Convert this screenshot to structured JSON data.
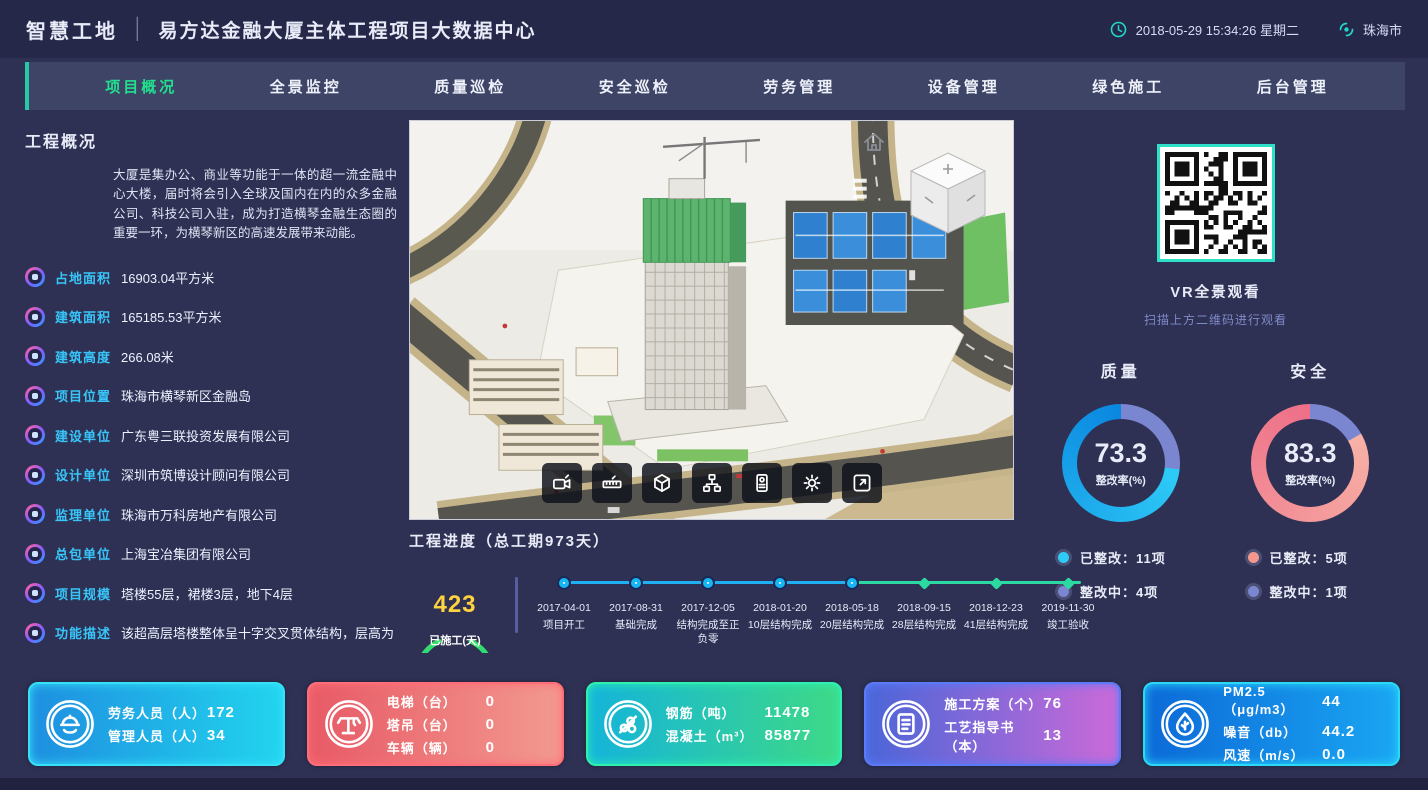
{
  "header": {
    "brand": "智慧工地",
    "title": "易方达金融大厦主体工程项目大数据中心",
    "datetime": "2018-05-29 15:34:26 星期二",
    "city": "珠海市"
  },
  "nav": {
    "items": [
      {
        "label": "项目概况",
        "active": true
      },
      {
        "label": "全景监控",
        "active": false
      },
      {
        "label": "质量巡检",
        "active": false
      },
      {
        "label": "安全巡检",
        "active": false
      },
      {
        "label": "劳务管理",
        "active": false
      },
      {
        "label": "设备管理",
        "active": false
      },
      {
        "label": "绿色施工",
        "active": false
      },
      {
        "label": "后台管理",
        "active": false
      }
    ]
  },
  "overview": {
    "title": "工程概况",
    "description": "大厦是集办公、商业等功能于一体的超一流金融中心大楼，届时将会引入全球及国内在内的众多金融公司、科技公司入驻，成为打造横琴金融生态圈的重要一环，为横琴新区的高速发展带来动能。",
    "fields": [
      {
        "label": "占地面积",
        "value": "16903.04平方米"
      },
      {
        "label": "建筑面积",
        "value": "165185.53平方米"
      },
      {
        "label": "建筑高度",
        "value": "266.08米"
      },
      {
        "label": "项目位置",
        "value": "珠海市横琴新区金融岛"
      },
      {
        "label": "建设单位",
        "value": "广东粤三联投资发展有限公司"
      },
      {
        "label": "设计单位",
        "value": "深圳市筑博设计顾问有限公司"
      },
      {
        "label": "监理单位",
        "value": "珠海市万科房地产有限公司"
      },
      {
        "label": "总包单位",
        "value": "上海宝冶集团有限公司"
      },
      {
        "label": "项目规模",
        "value": "塔楼55层，裙楼3层，地下4层"
      },
      {
        "label": "功能描述",
        "value": "该超高层塔楼整体呈十字交叉贯体结构，层高为"
      }
    ]
  },
  "viewer": {
    "toolbar_icons": [
      "video-icon",
      "measure-icon",
      "cube-icon",
      "structure-icon",
      "badge-icon",
      "settings-icon",
      "fullscreen-icon"
    ]
  },
  "progress": {
    "title": "工程进度（总工期973天）",
    "gauge": {
      "value": "423",
      "label": "已施工(天)"
    },
    "milestones": [
      {
        "date": "2017-04-01",
        "label": "项目开工",
        "done": true
      },
      {
        "date": "2017-08-31",
        "label": "基础完成",
        "done": true
      },
      {
        "date": "2017-12-05",
        "label": "结构完成至正负零",
        "done": true
      },
      {
        "date": "2018-01-20",
        "label": "10层结构完成",
        "done": true
      },
      {
        "date": "2018-05-18",
        "label": "20层结构完成",
        "done": true
      },
      {
        "date": "2018-09-15",
        "label": "28层结构完成",
        "done": false
      },
      {
        "date": "2018-12-23",
        "label": "41层结构完成",
        "done": false
      },
      {
        "date": "2019-11-30",
        "label": "竣工验收",
        "done": false
      }
    ]
  },
  "vr": {
    "title": "VR全景观看",
    "subtitle": "扫描上方二维码进行观看"
  },
  "chart_data": [
    {
      "type": "pie",
      "title": "质量",
      "center_value": "73.3",
      "center_label": "整改率(%)",
      "slices": [
        {
          "label": "已整改",
          "value": 11,
          "color": "#2ecbf7"
        },
        {
          "label": "整改中",
          "value": 4,
          "color": "#7b86d0"
        }
      ],
      "legend": [
        "已整改：11项",
        "整改中：4项"
      ]
    },
    {
      "type": "pie",
      "title": "安全",
      "center_value": "83.3",
      "center_label": "整改率(%)",
      "slices": [
        {
          "label": "已整改",
          "value": 5,
          "color": "#f4978e"
        },
        {
          "label": "整改中",
          "value": 1,
          "color": "#7b86d0"
        }
      ],
      "legend": [
        "已整改：5项",
        "整改中：1项"
      ]
    }
  ],
  "stat_cards": [
    {
      "icon": "worker-icon",
      "gradient": [
        "#1e8fe0",
        "#22d4ee"
      ],
      "border": "#35e0f8",
      "rows": [
        {
          "label": "劳务人员（人）",
          "value": "172"
        },
        {
          "label": "管理人员（人）",
          "value": "34"
        }
      ]
    },
    {
      "icon": "crane-icon",
      "gradient": [
        "#e85a66",
        "#f29a90"
      ],
      "border": "#ff6e78",
      "rows": [
        {
          "label": "电梯（台）",
          "value": "0"
        },
        {
          "label": "塔吊（台）",
          "value": "0"
        },
        {
          "label": "车辆（辆）",
          "value": "0"
        }
      ]
    },
    {
      "icon": "rebar-icon",
      "gradient": [
        "#14b4da",
        "#3ed986"
      ],
      "border": "#2ef0b0",
      "rows": [
        {
          "label": "钢筋（吨）",
          "value": "11478"
        },
        {
          "label": "混凝土（m³）",
          "value": "85877"
        }
      ]
    },
    {
      "icon": "document-icon",
      "gradient": [
        "#4a66d8",
        "#cc6ad8"
      ],
      "border": "#5a7af8",
      "rows": [
        {
          "label": "施工方案（个）",
          "value": "76"
        },
        {
          "label": "工艺指导书（本）",
          "value": "13"
        }
      ]
    },
    {
      "icon": "environment-icon",
      "gradient": [
        "#0c6ad8",
        "#1aa6f2"
      ],
      "border": "#2ad8f8",
      "rows": [
        {
          "label": "PM2.5（μg/m3）",
          "value": "44"
        },
        {
          "label": "噪音（db）",
          "value": "44.2"
        },
        {
          "label": "风速（m/s）",
          "value": "0.0"
        }
      ]
    }
  ]
}
